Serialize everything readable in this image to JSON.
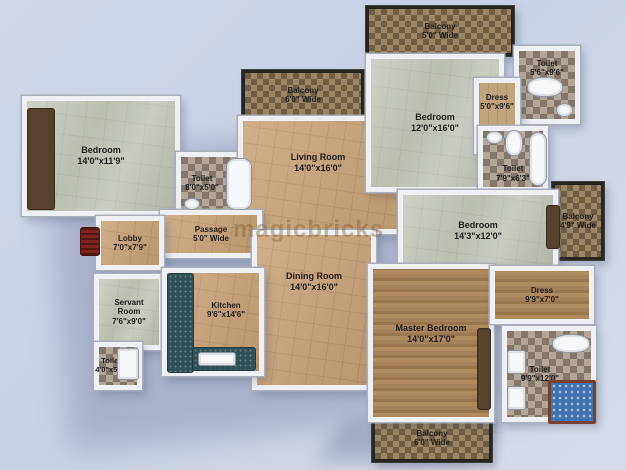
{
  "plan_title": "apartment-floor-plan",
  "watermark": "magicbricks",
  "rooms": {
    "bedroom1": {
      "name": "Bedroom",
      "dims": "14'0\"x11'9\""
    },
    "toilet1": {
      "name": "Toilet",
      "dims": "8'0\"x5'0\""
    },
    "balcony1": {
      "name": "Balcony",
      "dims": "6'0\" Wide"
    },
    "living": {
      "name": "Living Room",
      "dims": "14'0\"x16'0\""
    },
    "balcony2": {
      "name": "Balcony",
      "dims": "5'0\" Wide"
    },
    "bedroom2": {
      "name": "Bedroom",
      "dims": "12'0\"x16'0\""
    },
    "toilet2": {
      "name": "Toilet",
      "dims": "5'6\"x9'6\""
    },
    "dress1": {
      "name": "Dress",
      "dims": "5'0\"x9'6\""
    },
    "toilet3": {
      "name": "Toilet",
      "dims": "7'9\"x6'3\""
    },
    "balcony3": {
      "name": "Balcony",
      "dims": "4'9\" Wide"
    },
    "bedroom3": {
      "name": "Bedroom",
      "dims": "14'3\"x12'0\""
    },
    "passage": {
      "name": "Passage",
      "dims": "5'0\" Wide"
    },
    "lobby": {
      "name": "Lobby",
      "dims": "7'0\"x7'9\""
    },
    "dining": {
      "name": "Dining Room",
      "dims": "14'0\"x16'0\""
    },
    "servant": {
      "name": "Servant Room",
      "dims": "7'6\"x9'0\""
    },
    "kitchen": {
      "name": "Kitchen",
      "dims": "9'6\"x14'6\""
    },
    "toilet4": {
      "name": "Toilet",
      "dims": "4'0\"x5'0\""
    },
    "master": {
      "name": "Master Bedroom",
      "dims": "14'0\"x17'0\""
    },
    "dress2": {
      "name": "Dress",
      "dims": "9'9\"x7'0\""
    },
    "toilet5": {
      "name": "Toilet",
      "dims": "9'9\"x12'0\""
    },
    "balcony4": {
      "name": "Balcony",
      "dims": "6'0\" Wide"
    }
  },
  "colors": {
    "background": "#ccd4e6",
    "wall": "#eef0f4",
    "floor_tile": "#c7a074",
    "floor_bedroom": "#b9bfb1",
    "floor_wood": "#a5825a",
    "balcony_mosaic": "#8a7454",
    "toilet_checker": "#84766a",
    "kitchen_counter": "#2f5057",
    "jacuzzi_water": "#3f74b0",
    "entrance_door": "#7c241d"
  }
}
